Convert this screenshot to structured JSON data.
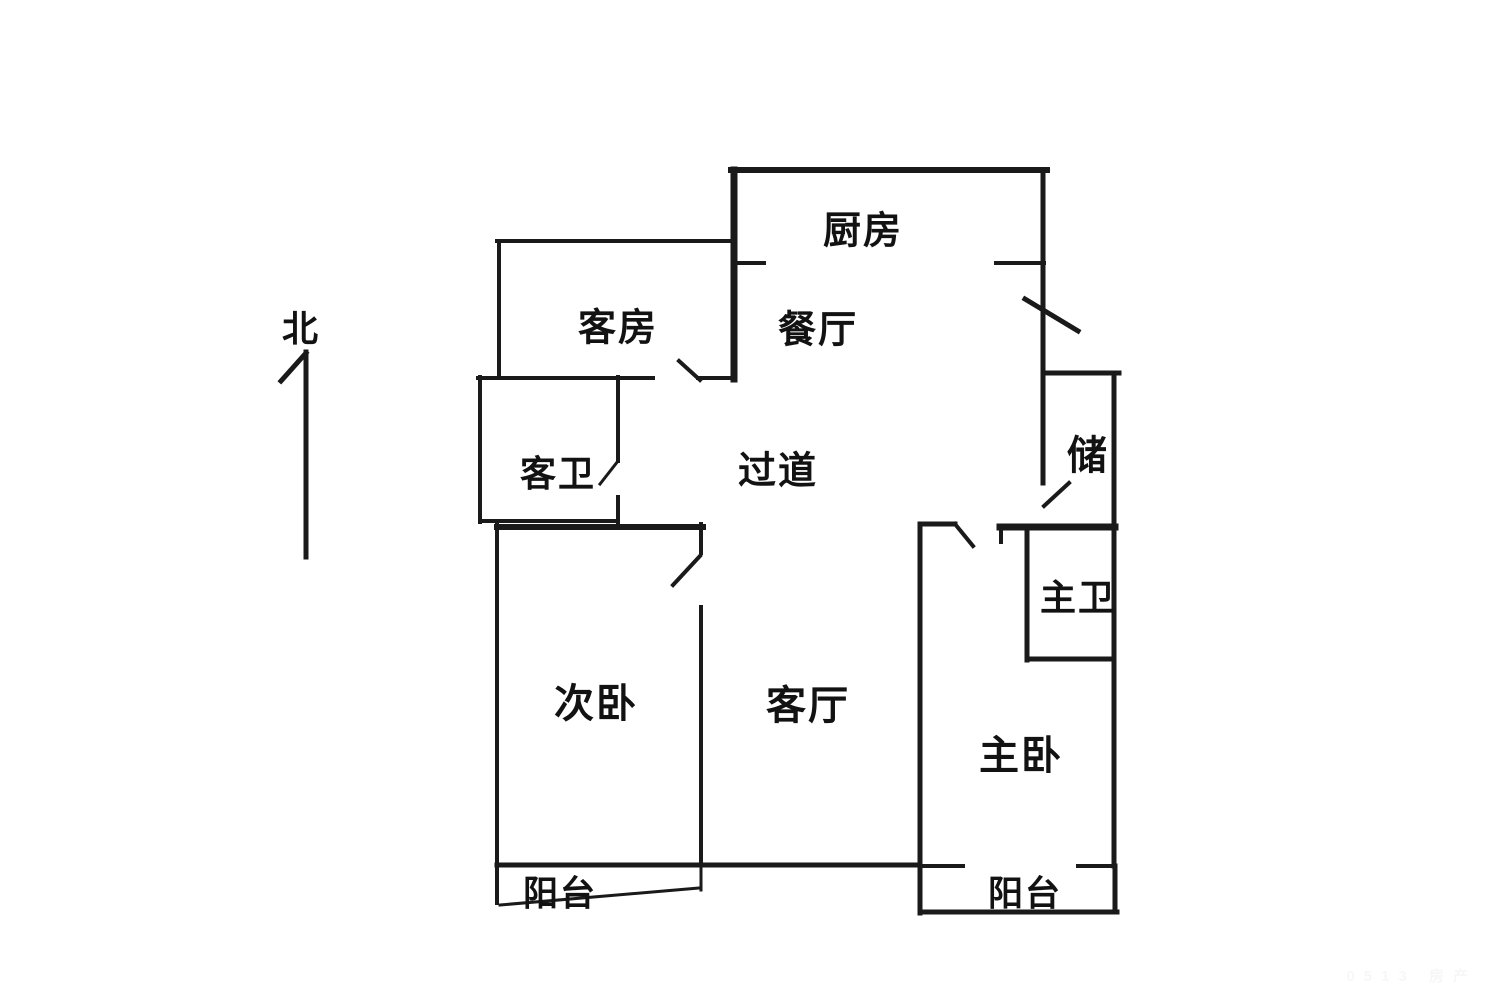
{
  "page": {
    "background": "#ffffff",
    "ink": "#1a1a1a"
  },
  "compass": {
    "label": "北"
  },
  "watermark": {
    "text": "0513 房产"
  },
  "floorplan": {
    "rooms": [
      {
        "id": "north",
        "label": "北",
        "x": 301,
        "y": 326,
        "size": 36
      },
      {
        "id": "kitchen",
        "label": "厨房",
        "x": 863,
        "y": 227,
        "size": 38
      },
      {
        "id": "guest-room",
        "label": "客房",
        "x": 618,
        "y": 324,
        "size": 38
      },
      {
        "id": "dining-room",
        "label": "餐厅",
        "x": 818,
        "y": 326,
        "size": 38
      },
      {
        "id": "guest-bathroom",
        "label": "客卫",
        "x": 558,
        "y": 471,
        "size": 36
      },
      {
        "id": "hallway",
        "label": "过道",
        "x": 778,
        "y": 467,
        "size": 38
      },
      {
        "id": "storage",
        "label": "储",
        "x": 1088,
        "y": 452,
        "size": 40
      },
      {
        "id": "master-bathroom",
        "label": "主卫",
        "x": 1078,
        "y": 595,
        "size": 36
      },
      {
        "id": "secondary-bedroom",
        "label": "次卧",
        "x": 596,
        "y": 700,
        "size": 40
      },
      {
        "id": "living-room",
        "label": "客厅",
        "x": 808,
        "y": 702,
        "size": 40
      },
      {
        "id": "master-bedroom",
        "label": "主卧",
        "x": 1021,
        "y": 752,
        "size": 40
      },
      {
        "id": "balcony-left",
        "label": "阳台",
        "x": 560,
        "y": 891,
        "size": 35
      },
      {
        "id": "balcony-right",
        "label": "阳台",
        "x": 1025,
        "y": 891,
        "size": 35
      }
    ],
    "walls": [
      {
        "name": "kitchen-top-wall",
        "x1": 731,
        "y1": 170,
        "x2": 1047,
        "y2": 170,
        "t": 6
      },
      {
        "name": "kitchen-left-wall",
        "x1": 734,
        "y1": 170,
        "x2": 734,
        "y2": 379,
        "t": 7
      },
      {
        "name": "right-exterior-wall-upper",
        "x1": 1043,
        "y1": 170,
        "x2": 1043,
        "y2": 483,
        "t": 5
      },
      {
        "name": "kitchen-bottom-wall-left",
        "x1": 734,
        "y1": 263,
        "x2": 764,
        "y2": 263,
        "t": 4
      },
      {
        "name": "kitchen-bottom-wall-right",
        "x1": 996,
        "y1": 263,
        "x2": 1044,
        "y2": 263,
        "t": 4
      },
      {
        "name": "entry-door-swing",
        "x1": 1025,
        "y1": 299,
        "x2": 1078,
        "y2": 331,
        "t": 5
      },
      {
        "name": "guest-room-top-wall",
        "x1": 497,
        "y1": 241,
        "x2": 734,
        "y2": 241,
        "t": 4
      },
      {
        "name": "guest-room-left-wall",
        "x1": 499,
        "y1": 241,
        "x2": 499,
        "y2": 378,
        "t": 4
      },
      {
        "name": "guest-room-bottom-wall-left",
        "x1": 478,
        "y1": 378,
        "x2": 653,
        "y2": 378,
        "t": 4
      },
      {
        "name": "guest-room-door-swing",
        "x1": 679,
        "y1": 361,
        "x2": 700,
        "y2": 380,
        "t": 4
      },
      {
        "name": "guest-room-bottom-wall-right",
        "x1": 698,
        "y1": 378,
        "x2": 734,
        "y2": 378,
        "t": 4
      },
      {
        "name": "guest-bath-left-wall",
        "x1": 480,
        "y1": 377,
        "x2": 480,
        "y2": 522,
        "t": 4
      },
      {
        "name": "guest-bath-bottom-wall",
        "x1": 480,
        "y1": 521,
        "x2": 618,
        "y2": 521,
        "t": 4
      },
      {
        "name": "guest-bath-right-wall-upper",
        "x1": 618,
        "y1": 377,
        "x2": 618,
        "y2": 461,
        "t": 4
      },
      {
        "name": "guest-bath-door-swing",
        "x1": 600,
        "y1": 484,
        "x2": 618,
        "y2": 461,
        "t": 3
      },
      {
        "name": "guest-bath-right-wall-lower",
        "x1": 618,
        "y1": 497,
        "x2": 618,
        "y2": 522,
        "t": 4
      },
      {
        "name": "storage-top-wall",
        "x1": 1043,
        "y1": 373,
        "x2": 1119,
        "y2": 373,
        "t": 5
      },
      {
        "name": "right-exterior-wall-lower",
        "x1": 1114,
        "y1": 373,
        "x2": 1114,
        "y2": 866,
        "t": 5
      },
      {
        "name": "storage-door-swing",
        "x1": 1044,
        "y1": 506,
        "x2": 1069,
        "y2": 483,
        "t": 4
      },
      {
        "name": "hallway-south-thick-wall",
        "x1": 1000,
        "y1": 527,
        "x2": 1115,
        "y2": 527,
        "t": 7
      },
      {
        "name": "thick-wall-end-tick",
        "x1": 1001,
        "y1": 527,
        "x2": 1001,
        "y2": 542,
        "t": 4
      },
      {
        "name": "master-bath-left-wall",
        "x1": 1027,
        "y1": 527,
        "x2": 1027,
        "y2": 660,
        "t": 5
      },
      {
        "name": "master-bath-bottom-wall",
        "x1": 1027,
        "y1": 659,
        "x2": 1114,
        "y2": 659,
        "t": 5
      },
      {
        "name": "master-bedroom-top-wall",
        "x1": 920,
        "y1": 524,
        "x2": 955,
        "y2": 524,
        "t": 5
      },
      {
        "name": "master-bedroom-door-swing",
        "x1": 955,
        "y1": 524,
        "x2": 973,
        "y2": 546,
        "t": 4
      },
      {
        "name": "master-bedroom-left-wall",
        "x1": 920,
        "y1": 524,
        "x2": 920,
        "y2": 913,
        "t": 5
      },
      {
        "name": "living-area-bottom-wall",
        "x1": 497,
        "y1": 865,
        "x2": 920,
        "y2": 865,
        "t": 5
      },
      {
        "name": "right-balcony-top-wall-left",
        "x1": 920,
        "y1": 866,
        "x2": 963,
        "y2": 866,
        "t": 4
      },
      {
        "name": "right-balcony-top-wall-right",
        "x1": 1078,
        "y1": 866,
        "x2": 1114,
        "y2": 866,
        "t": 4
      },
      {
        "name": "right-balcony-bottom-wall",
        "x1": 920,
        "y1": 912,
        "x2": 1117,
        "y2": 912,
        "t": 5
      },
      {
        "name": "right-balcony-right-wall",
        "x1": 1115,
        "y1": 866,
        "x2": 1115,
        "y2": 912,
        "t": 5
      },
      {
        "name": "secondary-bedroom-left-wall",
        "x1": 497,
        "y1": 524,
        "x2": 497,
        "y2": 903,
        "t": 4
      },
      {
        "name": "secondary-bedroom-top-wall",
        "x1": 497,
        "y1": 527,
        "x2": 703,
        "y2": 527,
        "t": 6
      },
      {
        "name": "secondary-bedroom-right-wall-upper",
        "x1": 701,
        "y1": 524,
        "x2": 701,
        "y2": 553,
        "t": 4
      },
      {
        "name": "secondary-bedroom-door-swing",
        "x1": 673,
        "y1": 585,
        "x2": 700,
        "y2": 556,
        "t": 4
      },
      {
        "name": "secondary-bedroom-right-wall-lower",
        "x1": 701,
        "y1": 607,
        "x2": 701,
        "y2": 865,
        "t": 4
      },
      {
        "name": "left-balcony-front-edge",
        "x1": 500,
        "y1": 905,
        "x2": 699,
        "y2": 888,
        "t": 3
      },
      {
        "name": "left-balcony-right-edge",
        "x1": 701,
        "y1": 865,
        "x2": 701,
        "y2": 890,
        "t": 3
      },
      {
        "name": "north-arrow-shaft",
        "x1": 306,
        "y1": 352,
        "x2": 306,
        "y2": 557,
        "t": 5
      },
      {
        "name": "north-arrow-head",
        "x1": 306,
        "y1": 353,
        "x2": 281,
        "y2": 381,
        "t": 5
      }
    ]
  }
}
